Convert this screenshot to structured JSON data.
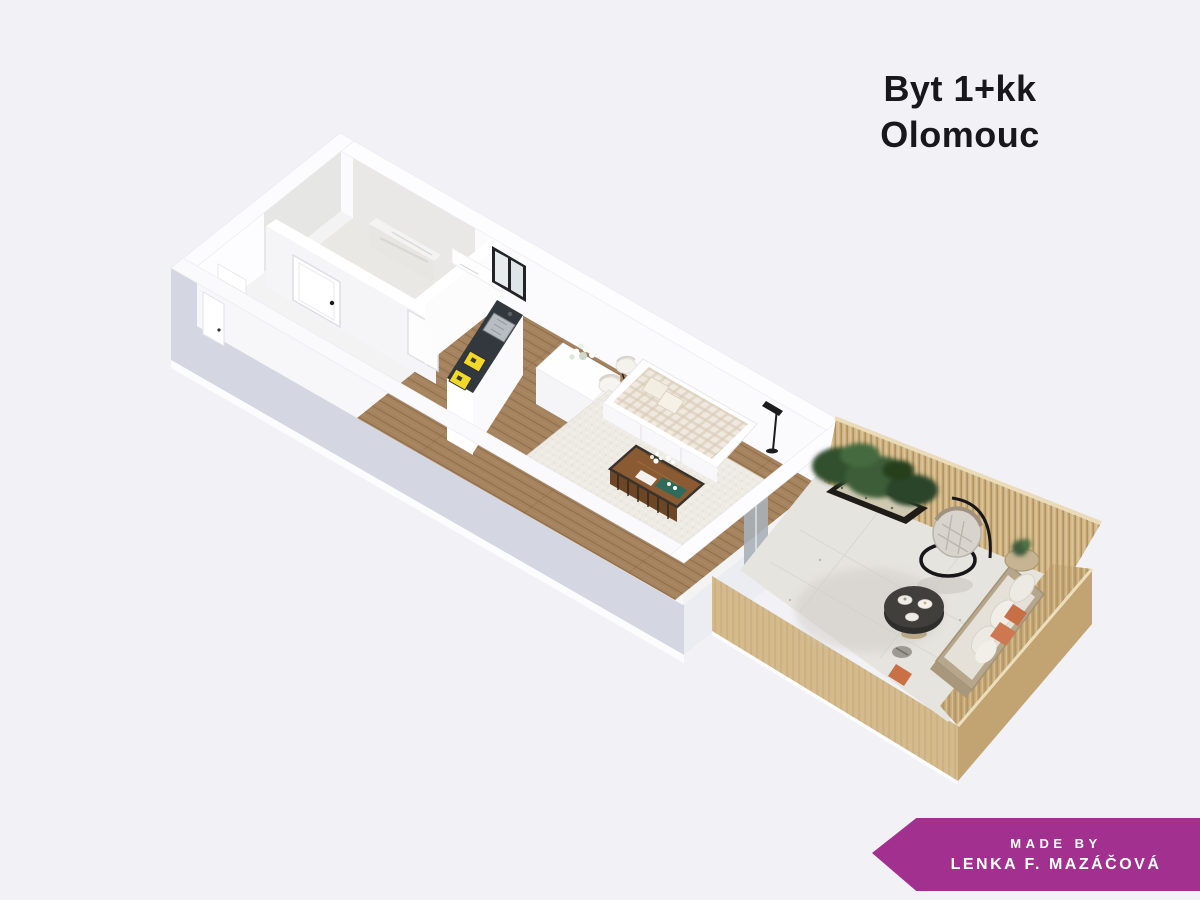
{
  "title": {
    "line1": "Byt 1+kk",
    "line2": "Olomouc"
  },
  "credit_banner": {
    "line1": "MADE BY",
    "line2": "LENKA F. MAZÁČOVÁ"
  },
  "colors": {
    "background": "#f2f2f6",
    "banner": "#a1308f",
    "title_text": "#17171c",
    "exterior_wall_shadow": "#d4d7e1",
    "interior_wall": "#fdfdfe",
    "wood_floor": "#a5835f",
    "rug": "#edebe3",
    "kitchen_counter": "#33383f",
    "stove_yellow": "#f2d829",
    "terrace_wood_light": "#d3b98b",
    "terrace_wood_inner": "#cfb586",
    "terrace_wood_dark": "#c2a372",
    "terrace_floor": "#e6e4df",
    "plant_green": "#34512f",
    "accent_pillow_orange": "#c76f46",
    "round_table_dark": "#3b3b39"
  }
}
